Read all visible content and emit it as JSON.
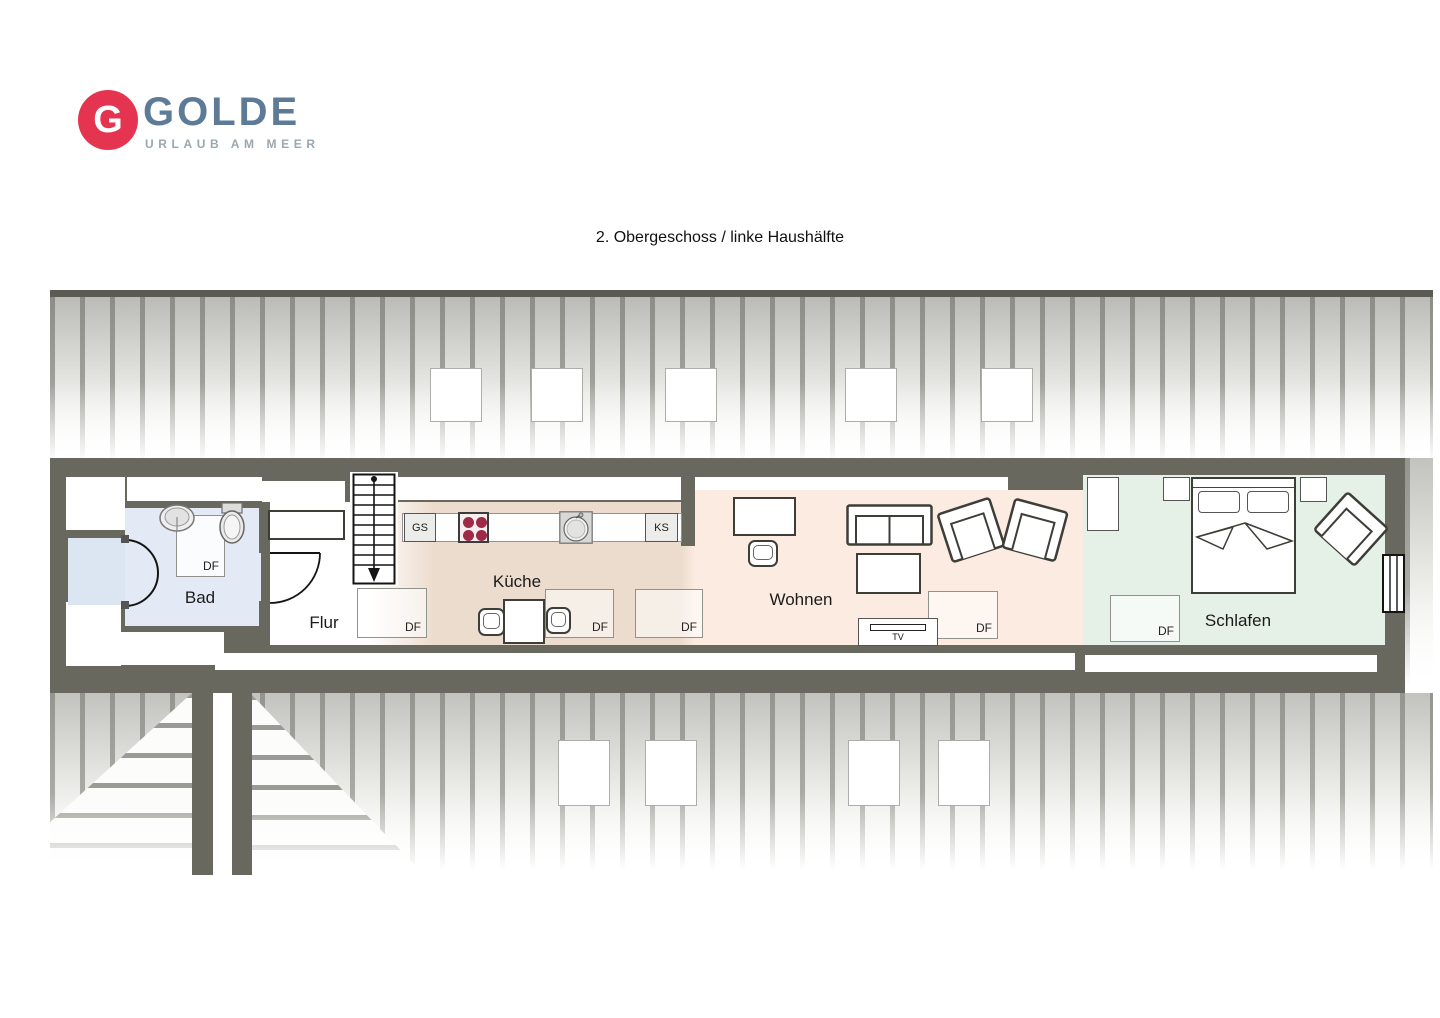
{
  "logo": {
    "monogram": "G",
    "brand": "GOLDE",
    "tagline": "URLAUB AM MEER"
  },
  "title": "2. Obergeschoss / linke Haushälfte",
  "rooms": {
    "bad": "Bad",
    "flur": "Flur",
    "kueche": "Küche",
    "wohnen": "Wohnen",
    "schlafen": "Schlafen"
  },
  "labels": {
    "roof_window": "DF",
    "dishwasher": "GS",
    "fridge": "KS",
    "tv": "TV"
  },
  "colors": {
    "wall": "#68685f",
    "logo_red": "#e5344f",
    "logo_blue": "#5d7b97",
    "logo_gray": "#9aa7b0",
    "bad_floor": "#e4eaf5",
    "annex_floor": "#dce5f2",
    "kueche_floor": "#ecdccd",
    "wohnen_floor": "#fcebe0",
    "schlafen_floor": "#e5f0e6",
    "burner": "#9e2a45"
  }
}
